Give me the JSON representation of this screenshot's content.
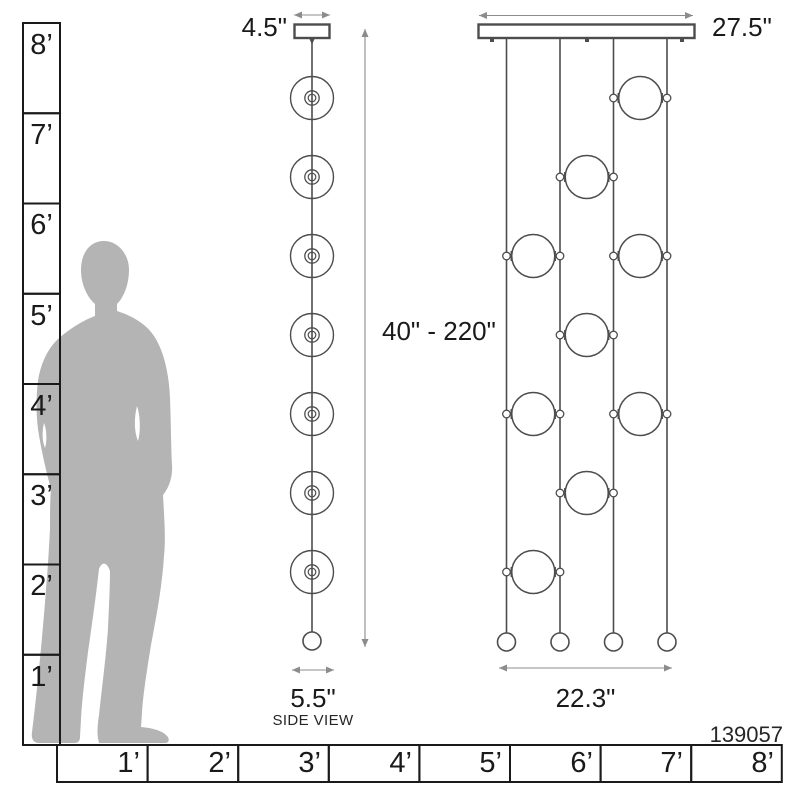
{
  "product_code": "139057",
  "rulers": {
    "vertical_labels": [
      "8’",
      "7’",
      "6’",
      "5’",
      "4’",
      "3’",
      "2’",
      "1’"
    ],
    "horizontal_labels": [
      "1’",
      "2’",
      "3’",
      "4’",
      "5’",
      "6’",
      "7’",
      "8’"
    ]
  },
  "side_view": {
    "caption": "SIDE VIEW",
    "canopy_width": "4.5\"",
    "fixture_width": "5.5\"",
    "height_range": "40\" - 220\"",
    "disc_rows_y": [
      98,
      177,
      256,
      335,
      414,
      493,
      572
    ]
  },
  "front_view": {
    "canopy_width": "27.5\"",
    "spread_width": "22.3\"",
    "rods_x": [
      506.5,
      560,
      613.5,
      667
    ],
    "sphere_columns_x": [
      533.25,
      586.75,
      640.25
    ],
    "sphere_rows": [
      {
        "y": 98,
        "cols": [
          2
        ]
      },
      {
        "y": 177,
        "cols": [
          1
        ]
      },
      {
        "y": 256,
        "cols": [
          0,
          2
        ]
      },
      {
        "y": 335,
        "cols": [
          1
        ]
      },
      {
        "y": 414,
        "cols": [
          0,
          2
        ]
      },
      {
        "y": 493,
        "cols": [
          1
        ]
      },
      {
        "y": 572,
        "cols": [
          0
        ]
      }
    ]
  },
  "colors": {
    "outline": "#4d4d4d",
    "ruler": "#1a1a1a",
    "dimension_arrow": "#8c8c8c",
    "silhouette": "#b4b4b4",
    "text": "#1a1a1a"
  }
}
